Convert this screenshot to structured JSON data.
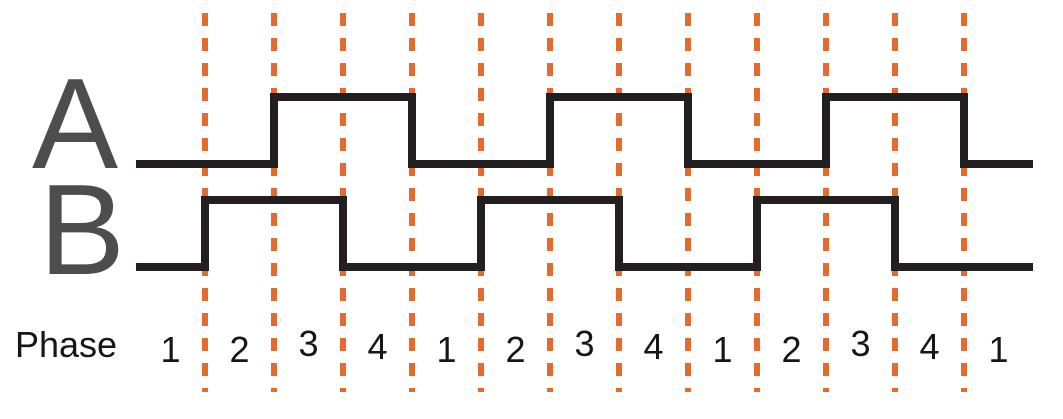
{
  "signal_rows": [
    {
      "label": "A",
      "levels_by_phase": [
        0,
        0,
        1,
        1,
        0,
        0,
        1,
        1,
        0,
        0,
        1,
        1,
        0
      ]
    },
    {
      "label": "B",
      "levels_by_phase": [
        0,
        1,
        1,
        0,
        0,
        1,
        1,
        0,
        0,
        1,
        1,
        0,
        0
      ]
    }
  ],
  "phase_row": {
    "label": "Phase",
    "numbers": [
      "1",
      "2",
      "3",
      "4",
      "1",
      "2",
      "3",
      "4",
      "1",
      "2",
      "3",
      "4",
      "1"
    ]
  },
  "colors": {
    "background": "#FFFFFF",
    "waveform": "#231F20",
    "signal_label": "#4D4D4F",
    "phase_divider": "#E56A2D",
    "phase_text": "#161616"
  }
}
